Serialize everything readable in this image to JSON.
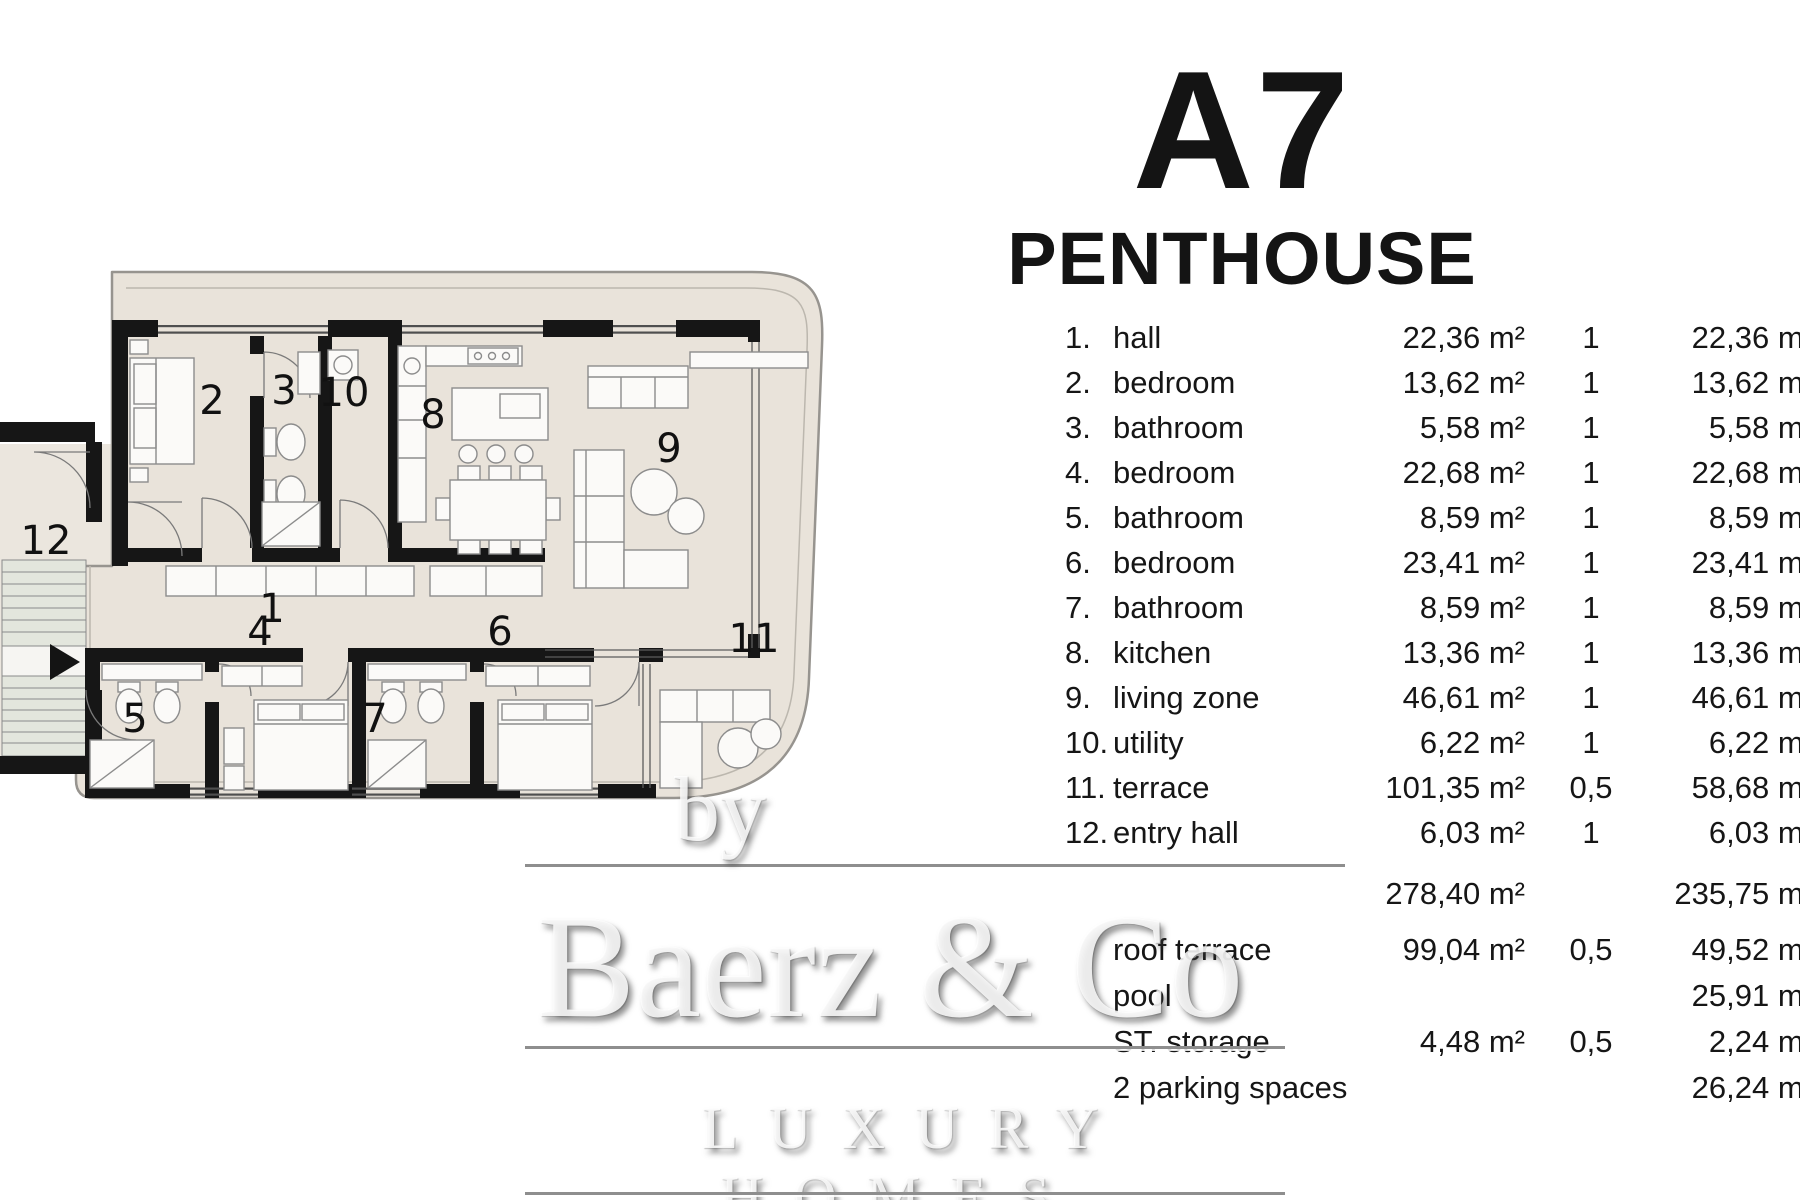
{
  "title": {
    "unit": "A7",
    "type": "PENTHOUSE"
  },
  "table": {
    "rooms": [
      {
        "num": "1.",
        "label": "hall",
        "area": "22,36 m²",
        "coef": "1",
        "total": "22,36 m²"
      },
      {
        "num": "2.",
        "label": "bedroom",
        "area": "13,62 m²",
        "coef": "1",
        "total": "13,62 m²"
      },
      {
        "num": "3.",
        "label": "bathroom",
        "area": "5,58 m²",
        "coef": "1",
        "total": "5,58 m²"
      },
      {
        "num": "4.",
        "label": "bedroom",
        "area": "22,68 m²",
        "coef": "1",
        "total": "22,68 m²"
      },
      {
        "num": "5.",
        "label": "bathroom",
        "area": "8,59 m²",
        "coef": "1",
        "total": "8,59 m²"
      },
      {
        "num": "6.",
        "label": "bedroom",
        "area": "23,41 m²",
        "coef": "1",
        "total": "23,41 m²"
      },
      {
        "num": "7.",
        "label": "bathroom",
        "area": "8,59 m²",
        "coef": "1",
        "total": "8,59 m²"
      },
      {
        "num": "8.",
        "label": "kitchen",
        "area": "13,36 m²",
        "coef": "1",
        "total": "13,36 m²"
      },
      {
        "num": "9.",
        "label": "living zone",
        "area": "46,61 m²",
        "coef": "1",
        "total": "46,61 m²"
      },
      {
        "num": "10.",
        "label": "utility",
        "area": "6,22 m²",
        "coef": "1",
        "total": "6,22 m²"
      },
      {
        "num": "11.",
        "label": "terrace",
        "area": "101,35 m²",
        "coef": "0,5",
        "total": "58,68 m²"
      },
      {
        "num": "12.",
        "label": "entry hall",
        "area": "6,03 m²",
        "coef": "1",
        "total": "6,03 m²"
      }
    ],
    "summary": {
      "area": "278,40 m²",
      "total": "235,75 m²"
    },
    "extras": [
      {
        "label": "roof terrace",
        "area": "99,04 m²",
        "coef": "0,5",
        "total": "49,52 m²"
      },
      {
        "label": "pool",
        "area": "",
        "coef": "",
        "total": "25,91 m²"
      },
      {
        "label": "ST. storage",
        "area": "4,48 m²",
        "coef": "0,5",
        "total": "2,24 m²"
      },
      {
        "label": "2 parking spaces",
        "area": "",
        "coef": "",
        "total": "26,24 m²"
      }
    ]
  },
  "watermark": {
    "by": "by",
    "brand": "Baerz & Co",
    "tagline": "LUXURY HOMES"
  },
  "plan": {
    "labels": {
      "r1": "1",
      "r2": "2",
      "r3": "3",
      "r4": "4",
      "r5": "5",
      "r6": "6",
      "r7": "7",
      "r8": "8",
      "r9": "9",
      "r10": "10",
      "r11": "11",
      "r12": "12"
    }
  },
  "colors": {
    "wall": "#161616",
    "band_fill": "#e9e3da",
    "band_stroke": "#97948f",
    "stairs_fill": "#e3e6dd",
    "furniture_stroke": "#8c8c8c",
    "watermark_line": "#8e8e8e"
  }
}
